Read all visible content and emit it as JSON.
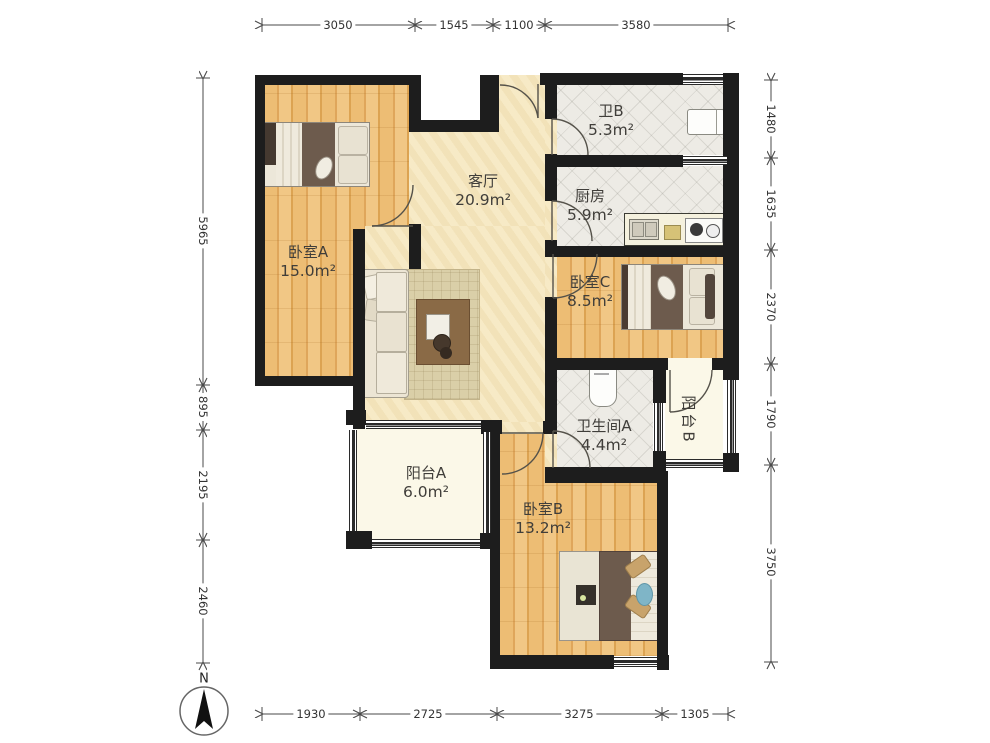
{
  "title": "apartment-floor-plan",
  "rooms": [
    {
      "id": "bedroom-a",
      "name": "卧室A",
      "area": "15.0m²"
    },
    {
      "id": "living",
      "name": "客厅",
      "area": "20.9m²"
    },
    {
      "id": "bath-b",
      "name": "卫B",
      "area": "5.3m²"
    },
    {
      "id": "kitchen",
      "name": "厨房",
      "area": "5.9m²"
    },
    {
      "id": "bedroom-c",
      "name": "卧室C",
      "area": "8.5m²"
    },
    {
      "id": "bath-a",
      "name": "卫生间A",
      "area": "4.4m²"
    },
    {
      "id": "balcony-b",
      "name": "阳台B",
      "area": ""
    },
    {
      "id": "balcony-a",
      "name": "阳台A",
      "area": "6.0m²"
    },
    {
      "id": "bedroom-b",
      "name": "卧室B",
      "area": "13.2m²"
    }
  ],
  "dimensions": {
    "top": [
      "3050",
      "1545",
      "1100",
      "3580"
    ],
    "bottom": [
      "1930",
      "2725",
      "3275",
      "1305"
    ],
    "left": [
      "5965",
      "895",
      "2195",
      "2460"
    ],
    "right": [
      "1480",
      "1635",
      "2370",
      "1790",
      "3750"
    ]
  },
  "compass": {
    "label": "N"
  },
  "colors": {
    "wall": "#1d1d1d",
    "wood_floor": "#eab96e",
    "living_floor": "#f6e9c5",
    "tile_floor": "#edebe5",
    "balcony_floor": "#fbf8e8",
    "rug": "#dacfa8",
    "dimension_text": "#333333"
  }
}
